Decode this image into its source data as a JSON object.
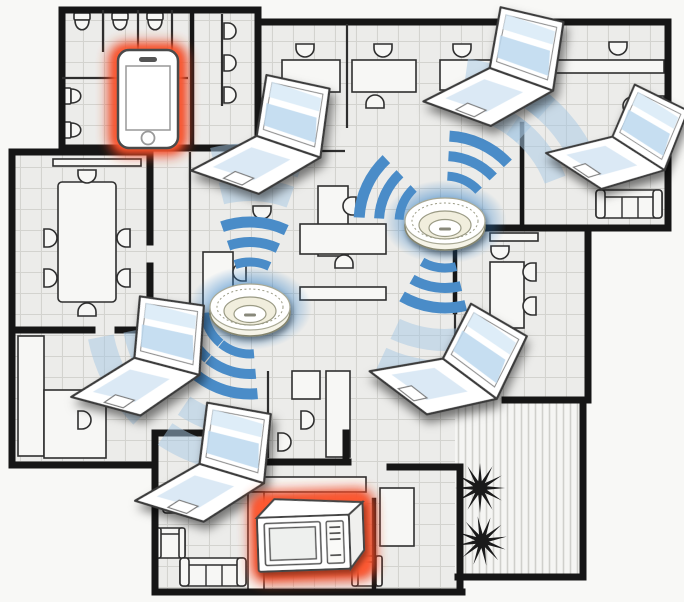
{
  "diagram": {
    "type": "office-floorplan-wifi-coverage",
    "colors": {
      "background": "#f8f8f6",
      "floor": "#ececea",
      "grid_line": "#d3d3cf",
      "wall": "#161616",
      "partition": "#2e2e2e",
      "furniture_fill": "#f7f7f5",
      "furniture_line": "#2f2f2f",
      "deck_floor": "#f5f5f3",
      "deck_stripe": "#cfcfcb",
      "wifi_arc": "#4a8cc8",
      "wifi_arc_light": "#a6c8e4",
      "ap_glow": "#2f7fc8",
      "interference_glow": "#ee4422",
      "interference_glow_core": "#ff5a30",
      "device_body": "#ffffff",
      "device_line": "#3a3a3a",
      "screen_tint": "#cfe2f2",
      "plant": "#1a1a1a"
    },
    "devices": [
      {
        "id": "access-point-center",
        "label": "Wireless access point (ceiling mounted), center office"
      },
      {
        "id": "access-point-east",
        "label": "Wireless access point (ceiling mounted), east office"
      },
      {
        "id": "laptop-top-center",
        "label": "Laptop with Wi-Fi connection, top center"
      },
      {
        "id": "laptop-top-right",
        "label": "Laptop with Wi-Fi connection, top right"
      },
      {
        "id": "laptop-right",
        "label": "Laptop with Wi-Fi connection, right"
      },
      {
        "id": "laptop-mid-left",
        "label": "Laptop with Wi-Fi connection, middle left"
      },
      {
        "id": "laptop-bottom-center",
        "label": "Laptop with Wi-Fi connection, bottom center"
      },
      {
        "id": "laptop-bottom-right",
        "label": "Laptop with Wi-Fi connection, bottom right"
      },
      {
        "id": "smartphone",
        "label": "Smartphone highlighted in red as interference source"
      },
      {
        "id": "microwave-oven",
        "label": "Microwave oven highlighted in red as interference source"
      }
    ],
    "signals": [
      {
        "ap": "access-point-center",
        "beam_angles_deg": [
          3,
          -118,
          -163
        ],
        "halo_angles_deg": [
          3,
          -118,
          -163
        ]
      },
      {
        "ap": "access-point-east",
        "beam_angles_deg": [
          -65,
          25,
          -172
        ],
        "halo_angles_deg": [
          25,
          52,
          -172
        ]
      }
    ]
  }
}
